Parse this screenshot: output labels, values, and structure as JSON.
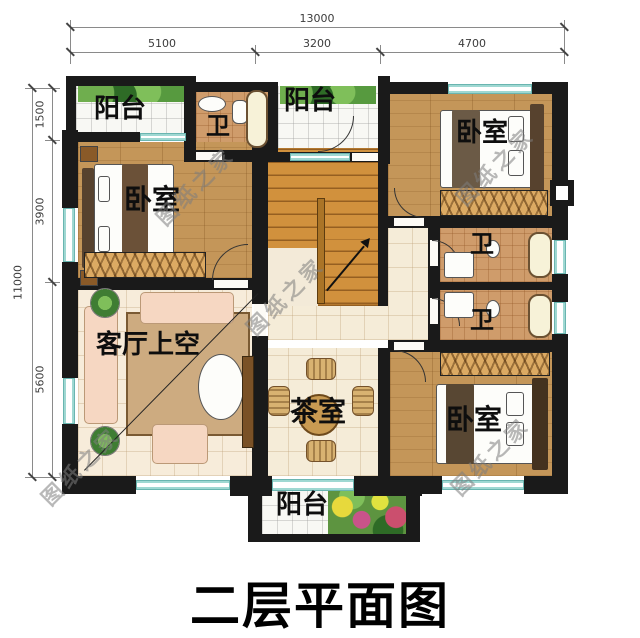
{
  "title": "二层平面图",
  "watermark": "图纸之家",
  "dimensions": {
    "top": {
      "total": "13000",
      "segments": [
        "5100",
        "3200",
        "4700"
      ]
    },
    "left": {
      "total": "11000",
      "segments": [
        "1500",
        "3900",
        "5600"
      ]
    }
  },
  "rooms": {
    "balcony_top_left": "阳台",
    "bath_top": "卫",
    "balcony_top_mid": "阳台",
    "bedroom_top_right": "卧室",
    "bedroom_left": "卧室",
    "living_void": "客厅上空",
    "bath_upper": "卫",
    "bath_lower": "卫",
    "tea_room": "茶室",
    "bedroom_bottom_right": "卧室",
    "balcony_bottom": "阳台"
  },
  "colors": {
    "wall": "#1a1a1a",
    "wood_floor": "#c49659",
    "cream_tile": "#f5ecd8",
    "window": "#8ccfc9",
    "stair": "#d1913d",
    "plant": "#4a8a3a"
  }
}
